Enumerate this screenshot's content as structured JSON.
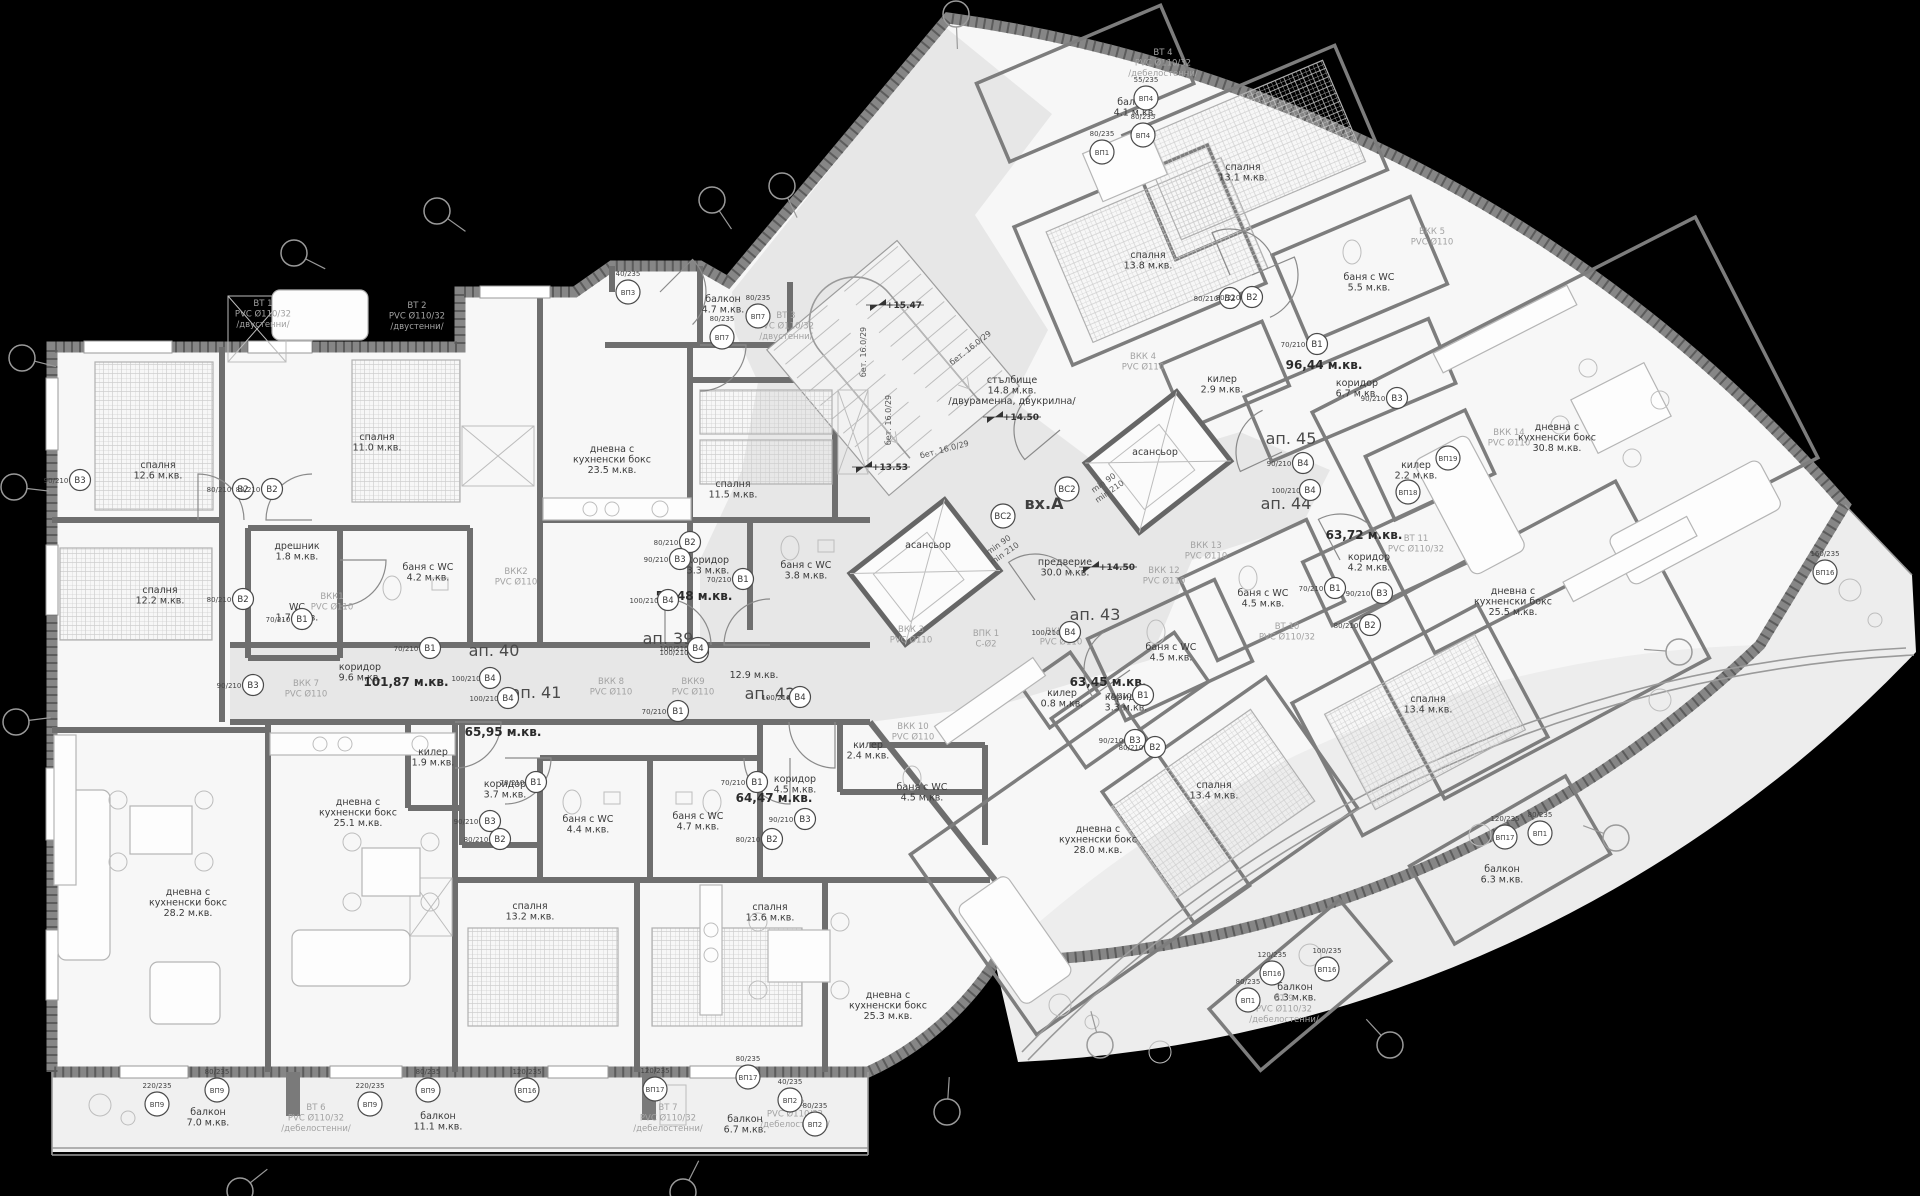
{
  "drawing": {
    "type": "architectural-floor-plan",
    "entrance_label": "вх.А",
    "background": "#000000",
    "floor_color": "#f7f7f7",
    "common_area_color": "#e7e7e7",
    "wall_color": "#6e6e6e"
  },
  "apartments": [
    {
      "t": "ап. 39",
      "x": 668,
      "y": 644
    },
    {
      "t": "ап. 40",
      "x": 494,
      "y": 656
    },
    {
      "t": "ап. 41",
      "x": 536,
      "y": 698
    },
    {
      "t": "ап. 42",
      "x": 770,
      "y": 699
    },
    {
      "t": "ап. 43",
      "x": 1095,
      "y": 620
    },
    {
      "t": "ап. 44",
      "x": 1286,
      "y": 509
    },
    {
      "t": "ап. 45",
      "x": 1291,
      "y": 444
    }
  ],
  "entrance": {
    "t": "вх.А",
    "x": 1044,
    "y": 509
  },
  "areas": [
    {
      "t": "53,48 м.кв.",
      "x": 694,
      "y": 600
    },
    {
      "t": "101,87 м.кв.",
      "x": 406,
      "y": 686
    },
    {
      "t": "65,95 м.кв.",
      "x": 503,
      "y": 736
    },
    {
      "t": "64,47 м.кв.",
      "x": 774,
      "y": 802
    },
    {
      "t": "63,45 м.кв.",
      "x": 1108,
      "y": 686
    },
    {
      "t": "63,72 м.кв.",
      "x": 1364,
      "y": 539
    },
    {
      "t": "96,44 м.кв.",
      "x": 1324,
      "y": 369
    }
  ],
  "rooms": [
    {
      "l": [
        "спалня",
        "12.6 м.кв."
      ],
      "x": 158,
      "y": 468
    },
    {
      "l": [
        "спалня",
        "11.0 м.кв."
      ],
      "x": 377,
      "y": 440
    },
    {
      "l": [
        "спалня",
        "12.2 м.кв."
      ],
      "x": 160,
      "y": 593
    },
    {
      "l": [
        "спалня",
        "11.5 м.кв."
      ],
      "x": 733,
      "y": 487
    },
    {
      "l": [
        "дневна с",
        "кухненски бокс",
        "23.5 м.кв."
      ],
      "x": 612,
      "y": 452
    },
    {
      "l": [
        "балкон",
        "4.7 м.кв."
      ],
      "x": 723,
      "y": 302
    },
    {
      "l": [
        "дрешник",
        "1.8 м.кв."
      ],
      "x": 297,
      "y": 549
    },
    {
      "l": [
        "WC",
        "1.7 м.кв."
      ],
      "x": 297,
      "y": 610
    },
    {
      "l": [
        "баня с WC",
        "4.2 м.кв."
      ],
      "x": 428,
      "y": 570
    },
    {
      "l": [
        "коридор",
        "9.6 м.кв."
      ],
      "x": 360,
      "y": 670
    },
    {
      "l": [
        "коридор",
        "3.3 м.кв."
      ],
      "x": 708,
      "y": 563
    },
    {
      "l": [
        "баня с WC",
        "3.8 м.кв."
      ],
      "x": 806,
      "y": 568
    },
    {
      "l": [
        "килер",
        "1.9 м.кв."
      ],
      "x": 433,
      "y": 755
    },
    {
      "l": [
        "коридор",
        "3.7 м.кв."
      ],
      "x": 505,
      "y": 787
    },
    {
      "l": [
        "баня с WC",
        "4.4 м.кв."
      ],
      "x": 588,
      "y": 822
    },
    {
      "l": [
        "баня с WC",
        "4.7 м.кв."
      ],
      "x": 698,
      "y": 819
    },
    {
      "l": [
        "коридор",
        "4.5 м.кв."
      ],
      "x": 795,
      "y": 782
    },
    {
      "l": [
        "спалня",
        "13.2 м.кв."
      ],
      "x": 530,
      "y": 909
    },
    {
      "l": [
        "спалня",
        "13.6 м.кв."
      ],
      "x": 770,
      "y": 910
    },
    {
      "l": [
        "дневна с",
        "кухненски бокс",
        "28.2 м.кв."
      ],
      "x": 188,
      "y": 895
    },
    {
      "l": [
        "дневна с",
        "кухненски бокс",
        "25.1 м.кв."
      ],
      "x": 358,
      "y": 805
    },
    {
      "l": [
        "дневна с",
        "кухненски бокс",
        "25.3 м.кв."
      ],
      "x": 888,
      "y": 998
    },
    {
      "l": [
        "балкон",
        "7.0 м.кв."
      ],
      "x": 208,
      "y": 1115
    },
    {
      "l": [
        "балкон",
        "11.1 м.кв."
      ],
      "x": 438,
      "y": 1119
    },
    {
      "l": [
        "балкон",
        "6.7 м.кв."
      ],
      "x": 745,
      "y": 1122
    },
    {
      "l": [
        "стълбище",
        "14.8 м.кв.",
        "/двураменна, двукрилна/"
      ],
      "x": 1012,
      "y": 383
    },
    {
      "l": [
        "предверие",
        "30.0 м.кв."
      ],
      "x": 1065,
      "y": 565
    },
    {
      "l": [
        "асансьор"
      ],
      "x": 928,
      "y": 548
    },
    {
      "l": [
        "асансьор"
      ],
      "x": 1155,
      "y": 455
    },
    {
      "l": [
        "спалня",
        "13.8 м.кв."
      ],
      "x": 1148,
      "y": 258
    },
    {
      "l": [
        "спалня",
        "13.1 м.кв."
      ],
      "x": 1243,
      "y": 170
    },
    {
      "l": [
        "балкон",
        "4.1 м.кв."
      ],
      "x": 1135,
      "y": 105
    },
    {
      "l": [
        "баня с WC",
        "5.5 м.кв."
      ],
      "x": 1369,
      "y": 280
    },
    {
      "l": [
        "килер",
        "2.9 м.кв."
      ],
      "x": 1222,
      "y": 382
    },
    {
      "l": [
        "коридор",
        "6.7 м.кв."
      ],
      "x": 1357,
      "y": 386
    },
    {
      "l": [
        "дневна с",
        "кухненски бокс",
        "30.8 м.кв."
      ],
      "x": 1557,
      "y": 430
    },
    {
      "l": [
        "килер",
        "2.2 м.кв."
      ],
      "x": 1416,
      "y": 468
    },
    {
      "l": [
        "коридор",
        "4.2 м.кв."
      ],
      "x": 1369,
      "y": 560
    },
    {
      "l": [
        "баня с WC",
        "4.5 м.кв."
      ],
      "x": 1263,
      "y": 596
    },
    {
      "l": [
        "баня с WC",
        "4.5 м.кв."
      ],
      "x": 1171,
      "y": 650
    },
    {
      "l": [
        "баня с WC",
        "4.5 м.кв."
      ],
      "x": 922,
      "y": 790
    },
    {
      "l": [
        "дневна с",
        "кухненски бокс",
        "25.5 м.кв."
      ],
      "x": 1513,
      "y": 594
    },
    {
      "l": [
        "спалня",
        "13.4 м.кв."
      ],
      "x": 1428,
      "y": 702
    },
    {
      "l": [
        "спалня",
        "13.4 м.кв."
      ],
      "x": 1214,
      "y": 788
    },
    {
      "l": [
        "дневна с",
        "кухненски бокс",
        "28.0 м.кв."
      ],
      "x": 1098,
      "y": 832
    },
    {
      "l": [
        "килер",
        "0.8 м.кв."
      ],
      "x": 1062,
      "y": 696
    },
    {
      "l": [
        "коридор",
        "3.3 м.кв."
      ],
      "x": 1126,
      "y": 700
    },
    {
      "l": [
        "килер",
        "2.4 м.кв."
      ],
      "x": 868,
      "y": 748
    },
    {
      "l": [
        "балкон",
        "6.3 м.кв."
      ],
      "x": 1295,
      "y": 990
    },
    {
      "l": [
        "балкон",
        "6.3 м.кв."
      ],
      "x": 1502,
      "y": 872
    },
    {
      "l": [
        "12.9 м.кв."
      ],
      "x": 754,
      "y": 678
    }
  ],
  "risers": [
    {
      "l": [
        "ВТ 1",
        "PVC Ø110/32",
        "/двустенни/"
      ],
      "x": 263,
      "y": 306
    },
    {
      "l": [
        "ВТ 2",
        "PVC Ø110/32",
        "/двустенни/"
      ],
      "x": 417,
      "y": 308
    },
    {
      "l": [
        "ВТ 3",
        "PVC Ø110/32",
        "/двустенни/"
      ],
      "x": 786,
      "y": 318
    },
    {
      "l": [
        "ВТ 4",
        "PVC Ø110/32",
        "/дебелостенни/"
      ],
      "x": 1163,
      "y": 55
    },
    {
      "l": [
        "ВТ 6",
        "PVC Ø110/32",
        "/дебелостенни/"
      ],
      "x": 316,
      "y": 1110
    },
    {
      "l": [
        "ВТ 7",
        "PVC Ø110/32",
        "/дебелостенни/"
      ],
      "x": 668,
      "y": 1110
    },
    {
      "l": [
        "ВТ 8",
        "PVC Ø110/32",
        "/дебелостенни/"
      ],
      "x": 795,
      "y": 1106
    },
    {
      "l": [
        "ВТ 9",
        "PVC Ø110/32",
        "/дебелостенни/"
      ],
      "x": 1284,
      "y": 1001
    },
    {
      "l": [
        "ВТ 10",
        "PVC Ø110/32"
      ],
      "x": 1287,
      "y": 629
    },
    {
      "l": [
        "ВТ 11",
        "PVC Ø110/32"
      ],
      "x": 1416,
      "y": 541
    },
    {
      "l": [
        "ВКК1",
        "PVC Ø110"
      ],
      "x": 332,
      "y": 599
    },
    {
      "l": [
        "ВКК2",
        "PVC Ø110"
      ],
      "x": 516,
      "y": 574
    },
    {
      "l": [
        "ВКК 3",
        "PVC Ø110"
      ],
      "x": 911,
      "y": 632
    },
    {
      "l": [
        "ВКК 4",
        "PVC Ø110"
      ],
      "x": 1143,
      "y": 359
    },
    {
      "l": [
        "ВКК 5",
        "PVC Ø110"
      ],
      "x": 1432,
      "y": 234
    },
    {
      "l": [
        "ВКК 7",
        "PVC Ø110"
      ],
      "x": 306,
      "y": 686
    },
    {
      "l": [
        "ВКК 8",
        "PVC Ø110"
      ],
      "x": 611,
      "y": 684
    },
    {
      "l": [
        "ВКК9",
        "PVC Ø110"
      ],
      "x": 693,
      "y": 684
    },
    {
      "l": [
        "ВКК 10",
        "PVC Ø110"
      ],
      "x": 913,
      "y": 729
    },
    {
      "l": [
        "ВКК 11",
        "PVC Ø110"
      ],
      "x": 1061,
      "y": 634
    },
    {
      "l": [
        "ВКК 12",
        "PVC Ø110"
      ],
      "x": 1164,
      "y": 573
    },
    {
      "l": [
        "ВКК 13",
        "PVC Ø110"
      ],
      "x": 1206,
      "y": 548
    },
    {
      "l": [
        "ВКК 14",
        "PVC Ø110"
      ],
      "x": 1509,
      "y": 435
    },
    {
      "l": [
        "ВПК 1",
        "С-Ø2"
      ],
      "x": 986,
      "y": 636
    }
  ],
  "door_tags": [
    {
      "t": "В2",
      "dim": "80/210",
      "x": 243,
      "y": 489
    },
    {
      "t": "В2",
      "dim": "80/210",
      "x": 272,
      "y": 489
    },
    {
      "t": "В3",
      "dim": "90/210",
      "x": 80,
      "y": 480
    },
    {
      "t": "В2",
      "dim": "80/210",
      "x": 243,
      "y": 599
    },
    {
      "t": "В1",
      "dim": "70/210",
      "x": 302,
      "y": 619
    },
    {
      "t": "В3",
      "dim": "90/210",
      "x": 253,
      "y": 685
    },
    {
      "t": "В1",
      "dim": "70/210",
      "x": 430,
      "y": 648
    },
    {
      "t": "В4",
      "dim": "100/210",
      "x": 490,
      "y": 678
    },
    {
      "t": "В4",
      "dim": "100/210",
      "x": 508,
      "y": 698
    },
    {
      "t": "В4",
      "dim": "100/210",
      "x": 698,
      "y": 652
    },
    {
      "t": "В4",
      "dim": "100/210",
      "x": 800,
      "y": 697
    },
    {
      "t": "В1",
      "dim": "70/210",
      "x": 536,
      "y": 782
    },
    {
      "t": "В1",
      "dim": "70/210",
      "x": 757,
      "y": 782
    },
    {
      "t": "В3",
      "dim": "90/210",
      "x": 490,
      "y": 821
    },
    {
      "t": "В2",
      "dim": "80/210",
      "x": 500,
      "y": 839
    },
    {
      "t": "В3",
      "dim": "90/210",
      "x": 805,
      "y": 819
    },
    {
      "t": "В2",
      "dim": "80/210",
      "x": 772,
      "y": 839
    },
    {
      "t": "В1",
      "dim": "70/210",
      "x": 678,
      "y": 711
    },
    {
      "t": "В2",
      "dim": "80/210",
      "x": 690,
      "y": 542
    },
    {
      "t": "В1",
      "dim": "70/210",
      "x": 743,
      "y": 579
    },
    {
      "t": "В3",
      "dim": "90/210",
      "x": 680,
      "y": 559
    },
    {
      "t": "В4",
      "dim": "100/210",
      "x": 668,
      "y": 600
    },
    {
      "t": "В2",
      "dim": "80/210",
      "x": 1230,
      "y": 298
    },
    {
      "t": "В2",
      "dim": "80/210",
      "x": 1252,
      "y": 297
    },
    {
      "t": "В1",
      "dim": "70/210",
      "x": 1317,
      "y": 344
    },
    {
      "t": "В3",
      "dim": "90/210",
      "x": 1397,
      "y": 398
    },
    {
      "t": "В4",
      "dim": "90/210",
      "x": 1303,
      "y": 463
    },
    {
      "t": "В4",
      "dim": "100/210",
      "x": 1310,
      "y": 490
    },
    {
      "t": "В4",
      "dim": "100/210",
      "x": 1070,
      "y": 632
    },
    {
      "t": "В1",
      "dim": "70/210",
      "x": 1143,
      "y": 695
    },
    {
      "t": "В1",
      "dim": "70/210",
      "x": 1335,
      "y": 588
    },
    {
      "t": "В3",
      "dim": "90/210",
      "x": 1135,
      "y": 740
    },
    {
      "t": "В3",
      "dim": "90/210",
      "x": 1382,
      "y": 593
    },
    {
      "t": "В2",
      "dim": "80/210",
      "x": 1155,
      "y": 747
    },
    {
      "t": "В2",
      "dim": "80/210",
      "x": 1370,
      "y": 625
    },
    {
      "t": "В4",
      "dim": "100/210",
      "x": 698,
      "y": 648
    }
  ],
  "window_tags": [
    {
      "t": "ВП3",
      "dim": "40/235",
      "x": 628,
      "y": 292
    },
    {
      "t": "ВП7",
      "dim": "80/235",
      "x": 722,
      "y": 337
    },
    {
      "t": "ВП7",
      "dim": "80/235",
      "x": 758,
      "y": 316
    },
    {
      "t": "ВП1",
      "dim": "80/235",
      "x": 1102,
      "y": 152
    },
    {
      "t": "ВП4",
      "dim": "55/235",
      "x": 1146,
      "y": 98
    },
    {
      "t": "ВП4",
      "dim": "80/235",
      "x": 1143,
      "y": 135
    },
    {
      "t": "ВП9",
      "dim": "220/235",
      "x": 157,
      "y": 1104
    },
    {
      "t": "ВП9",
      "dim": "80/235",
      "x": 217,
      "y": 1090
    },
    {
      "t": "ВП9",
      "dim": "220/235",
      "x": 370,
      "y": 1104
    },
    {
      "t": "ВП9",
      "dim": "80/235",
      "x": 428,
      "y": 1090
    },
    {
      "t": "ВП16",
      "dim": "120/235",
      "x": 527,
      "y": 1090
    },
    {
      "t": "ВП17",
      "dim": "120/235",
      "x": 655,
      "y": 1089
    },
    {
      "t": "ВП17",
      "dim": "80/235",
      "x": 748,
      "y": 1077
    },
    {
      "t": "ВП2",
      "dim": "40/235",
      "x": 790,
      "y": 1100
    },
    {
      "t": "ВП2",
      "dim": "80/235",
      "x": 815,
      "y": 1124
    },
    {
      "t": "ВП16",
      "dim": "120/235",
      "x": 1272,
      "y": 973
    },
    {
      "t": "ВП16",
      "dim": "100/235",
      "x": 1327,
      "y": 969
    },
    {
      "t": "ВП1",
      "dim": "80/235",
      "x": 1248,
      "y": 1000
    },
    {
      "t": "ВП17",
      "dim": "120/235",
      "x": 1505,
      "y": 837
    },
    {
      "t": "ВП1",
      "dim": "80/235",
      "x": 1540,
      "y": 833
    },
    {
      "t": "ВП18",
      "dim": "",
      "x": 1408,
      "y": 492
    },
    {
      "t": "ВП19",
      "dim": "",
      "x": 1448,
      "y": 458
    },
    {
      "t": "ВП16",
      "dim": "160/235",
      "x": 1825,
      "y": 572
    }
  ],
  "levels": [
    {
      "t": "+15.47",
      "x": 890,
      "y": 308
    },
    {
      "t": "+14.50",
      "x": 1007,
      "y": 420
    },
    {
      "t": "+14.50",
      "x": 1103,
      "y": 570
    },
    {
      "t": "+13.53",
      "x": 876,
      "y": 470
    }
  ],
  "notes": [
    {
      "l": [
        "бет. 16.0/29"
      ],
      "x": 866,
      "y": 352,
      "rot": -90
    },
    {
      "l": [
        "бет. 16.0/29"
      ],
      "x": 891,
      "y": 420,
      "rot": -90
    },
    {
      "l": [
        "бет. 16.0/29"
      ],
      "x": 972,
      "y": 350,
      "rot": -38
    },
    {
      "l": [
        "бет. 16.0/29"
      ],
      "x": 945,
      "y": 452,
      "rot": -15
    },
    {
      "l": [
        "min 90",
        "min 210"
      ],
      "x": 1105,
      "y": 485,
      "rot": -35
    },
    {
      "l": [
        "min 90",
        "min 210"
      ],
      "x": 1000,
      "y": 547,
      "rot": -35
    }
  ],
  "vs_tags": [
    {
      "t": "ВС2",
      "x": 1067,
      "y": 489
    },
    {
      "t": "ВС2",
      "x": 1003,
      "y": 516
    }
  ],
  "axis_markers": [
    [
      22,
      358
    ],
    [
      14,
      487
    ],
    [
      16,
      722
    ],
    [
      294,
      253
    ],
    [
      437,
      211
    ],
    [
      712,
      200
    ],
    [
      782,
      186
    ],
    [
      956,
      14
    ],
    [
      1679,
      652
    ],
    [
      1616,
      838
    ],
    [
      1390,
      1045
    ],
    [
      947,
      1112
    ],
    [
      240,
      1191
    ],
    [
      683,
      1192
    ],
    [
      1100,
      1045
    ]
  ]
}
